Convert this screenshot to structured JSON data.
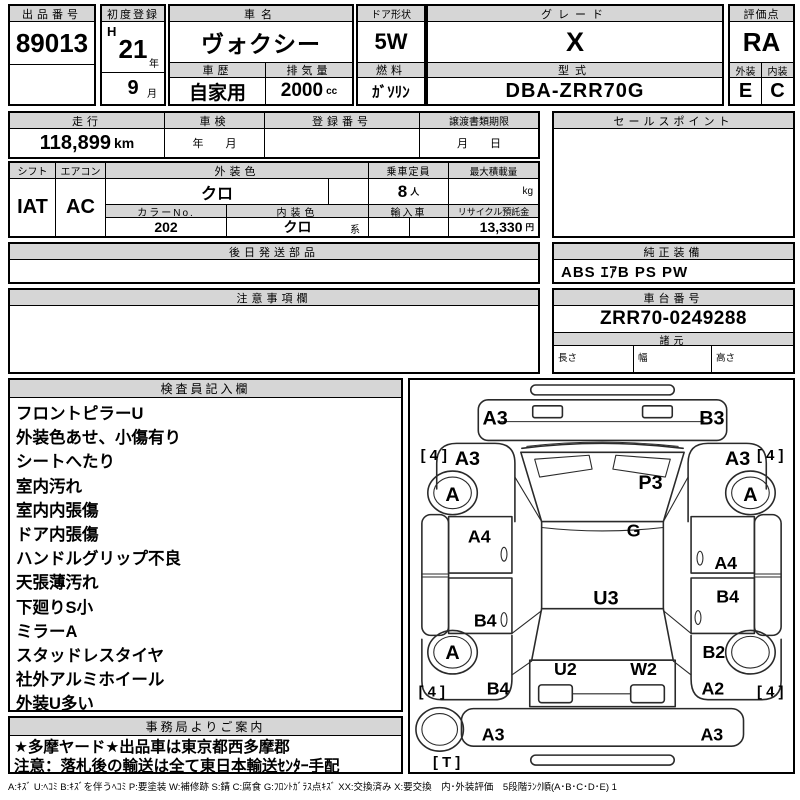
{
  "colors": {
    "header_bg": "#d6d6d6",
    "border": "#000000",
    "paper": "#ffffff"
  },
  "sheet": {
    "top": {
      "auction_no_label": "出品番号",
      "auction_no": "89013",
      "first_reg_label": "初度登録",
      "era": "H",
      "reg_year": "21",
      "year_suffix": "年",
      "reg_month": "9",
      "month_suffix": "月",
      "car_name_label": "車名",
      "car_name": "ヴォクシー",
      "door_label": "ドア形状",
      "door": "5W",
      "grade_label": "グレード",
      "grade": "X",
      "score_label": "評価点",
      "score": "RA",
      "history_label": "車歴",
      "history": "自家用",
      "disp_label": "排気量",
      "displacement": "2000",
      "disp_unit": "cc",
      "fuel_label": "燃料",
      "fuel": "ｶﾞｿﾘﾝ",
      "model_label": "型式",
      "model": "DBA-ZRR70G",
      "ext_label": "外装",
      "ext_score": "E",
      "int_label": "内装",
      "int_score": "C"
    },
    "mid": {
      "mileage_label": "走行",
      "mileage": "118,899",
      "mileage_unit": "km",
      "shaken_label": "車検",
      "shaken_hint": "年　　月",
      "regno_label": "登録番号",
      "regno": "",
      "transfer_label": "譲渡書類期限",
      "transfer_hint": "月　　日",
      "sales_label": "セールスポイント",
      "sales_point": "",
      "shift_label": "シフト",
      "shift": "IAT",
      "ac_label": "エアコン",
      "ac": "AC",
      "extcolor_label": "外装色",
      "ext_color": "クロ",
      "colorno_label": "カラーNo.",
      "color_no": "202",
      "intcolor_label": "内装色",
      "int_color": "クロ",
      "int_color_suffix": "系",
      "capacity_label": "乗車定員",
      "capacity": "8",
      "capacity_unit": "人",
      "maxload_label": "最大積載量",
      "max_load": "",
      "maxload_unit": "kg",
      "import_label": "輸入車",
      "import_value": "",
      "recycle_label": "リサイクル預託金",
      "recycle": "13,330",
      "recycle_unit": "円"
    },
    "parts": {
      "label": "後日発送部品",
      "value": ""
    },
    "equipment": {
      "label": "純正装備",
      "value": "ABS ｴｱB PS PW"
    },
    "caution": {
      "label": "注意事項欄",
      "value": ""
    },
    "chassis": {
      "label": "車台番号",
      "value": "ZRR70-0249288",
      "specs_label": "諸元",
      "length_label": "長さ",
      "length": "",
      "width_label": "幅",
      "width": "",
      "height_label": "高さ",
      "height": ""
    },
    "inspector": {
      "label": "検査員記入欄",
      "lines": [
        "フロントピラーU",
        "外装色あせ、小傷有り",
        "シートへたり",
        "室内汚れ",
        "室内内張傷",
        "ドア内張傷",
        "ハンドルグリップ不良",
        "天張薄汚れ",
        "下廻りS小",
        "ミラーA",
        "スタッドレスタイヤ",
        "社外アルミホイール",
        "外装U多い"
      ]
    },
    "office": {
      "label": "事務局よりご案内",
      "lines": [
        "★多摩ヤード★出品車は東京都西多摩郡",
        "注意：落札後の輸送は全て東日本輸送ｾﾝﾀｰ手配"
      ]
    },
    "legend": "A:ｷｽﾞ U:ﾍｺﾐ B:ｷｽﾞを伴うﾍｺﾐ P:要塗装 W:補修跡 S:錆 C:腐食 G:ﾌﾛﾝﾄｶﾞﾗｽ点ｷｽﾞ XX:交換済み X:要交換　内･外装評価　5段階ﾗﾝｸ順(A･B･C･D･E) 1"
  },
  "diagram": {
    "labels": [
      {
        "id": "front-bumper-left",
        "text": "A3",
        "x": 86,
        "y": 45,
        "size": 20
      },
      {
        "id": "front-bumper-right",
        "text": "B3",
        "x": 305,
        "y": 45,
        "size": 20
      },
      {
        "id": "front-fender-left",
        "text": "A3",
        "x": 58,
        "y": 86,
        "size": 20
      },
      {
        "id": "front-fender-right",
        "text": "A3",
        "x": 331,
        "y": 86,
        "size": 20
      },
      {
        "id": "tire-front-left",
        "text": "[ 4 ]",
        "x": 24,
        "y": 81,
        "size": 15
      },
      {
        "id": "tire-front-right",
        "text": "[ 4 ]",
        "x": 364,
        "y": 81,
        "size": 15
      },
      {
        "id": "wheel-front-left",
        "text": "A",
        "x": 43,
        "y": 122,
        "size": 20
      },
      {
        "id": "wheel-front-right",
        "text": "A",
        "x": 344,
        "y": 122,
        "size": 20
      },
      {
        "id": "hood",
        "text": "P3",
        "x": 243,
        "y": 110,
        "size": 20
      },
      {
        "id": "cowl",
        "text": "G",
        "x": 226,
        "y": 158,
        "size": 18
      },
      {
        "id": "door-front-left",
        "text": "A4",
        "x": 70,
        "y": 164,
        "size": 18
      },
      {
        "id": "door-front-right",
        "text": "A4",
        "x": 319,
        "y": 191,
        "size": 18
      },
      {
        "id": "door-rear-left",
        "text": "B4",
        "x": 76,
        "y": 249,
        "size": 18
      },
      {
        "id": "door-rear-right",
        "text": "B4",
        "x": 321,
        "y": 225,
        "size": 18
      },
      {
        "id": "roof",
        "text": "U3",
        "x": 198,
        "y": 227,
        "size": 20
      },
      {
        "id": "quarter-rear-left",
        "text": "B4",
        "x": 89,
        "y": 318,
        "size": 18
      },
      {
        "id": "quarter-rear-right-upper",
        "text": "B2",
        "x": 307,
        "y": 281,
        "size": 18
      },
      {
        "id": "quarter-rear-right-lower",
        "text": "A2",
        "x": 306,
        "y": 318,
        "size": 18
      },
      {
        "id": "tailgate-left",
        "text": "U2",
        "x": 157,
        "y": 298,
        "size": 18
      },
      {
        "id": "tailgate-right",
        "text": "W2",
        "x": 236,
        "y": 298,
        "size": 18
      },
      {
        "id": "tire-rear-left",
        "text": "[ 4 ]",
        "x": 22,
        "y": 320,
        "size": 15
      },
      {
        "id": "tire-rear-right",
        "text": "[ 4 ]",
        "x": 364,
        "y": 320,
        "size": 15
      },
      {
        "id": "wheel-rear-left",
        "text": "A",
        "x": 43,
        "y": 282,
        "size": 20
      },
      {
        "id": "rear-bumper-left",
        "text": "A3",
        "x": 84,
        "y": 364,
        "size": 18
      },
      {
        "id": "rear-bumper-right",
        "text": "A3",
        "x": 305,
        "y": 364,
        "size": 18
      },
      {
        "id": "spare-tire",
        "text": "[ T ]",
        "x": 37,
        "y": 391,
        "size": 15
      }
    ]
  }
}
